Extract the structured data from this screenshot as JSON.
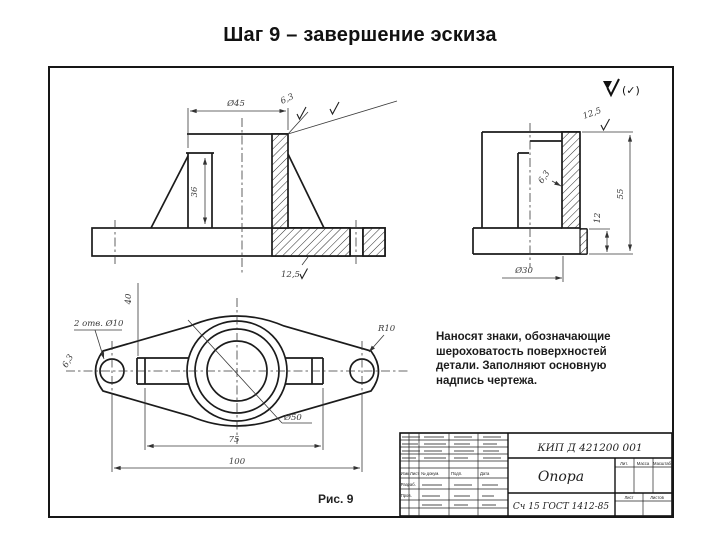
{
  "slide": {
    "title": "Шаг 9 – завершение эскиза"
  },
  "drawing": {
    "general_roughness": "(✓)",
    "note": "Наносят знаки, обозначающие шероховатость поверхностей детали. Заполняют основную надпись чертежа.",
    "caption": "Рис. 9",
    "front_view": {
      "width_dia": "Ø45",
      "roughness_top": "6,3",
      "height": "36",
      "roughness_base": "12,5"
    },
    "side_view": {
      "roughness_top": "12,5",
      "roughness_wall": "6,3",
      "height": "55",
      "foot": "12",
      "width_dia": "Ø30"
    },
    "plan_view": {
      "holes": "2 отв. Ø10",
      "roughness_hole": "6,3",
      "boss_width": "40",
      "radius": "R10",
      "center_dia": "Ø50",
      "span_inner": "75",
      "span_outer": "100"
    },
    "title_block": {
      "designation": "КИП Д 421200 001",
      "part_name": "Опора",
      "material": "Сч 15 ГОСТ 1412-85",
      "col_izm": "Изм.",
      "col_list": "Лист",
      "col_dokum": "№ докум.",
      "col_podp": "Подп.",
      "col_data": "Дата",
      "row_razrab": "Разраб.",
      "row_prov": "Пров.",
      "lit": "Лит.",
      "massa": "Масса",
      "masshtab": "Масштаб",
      "list": "Лист",
      "listov": "Листов"
    }
  }
}
